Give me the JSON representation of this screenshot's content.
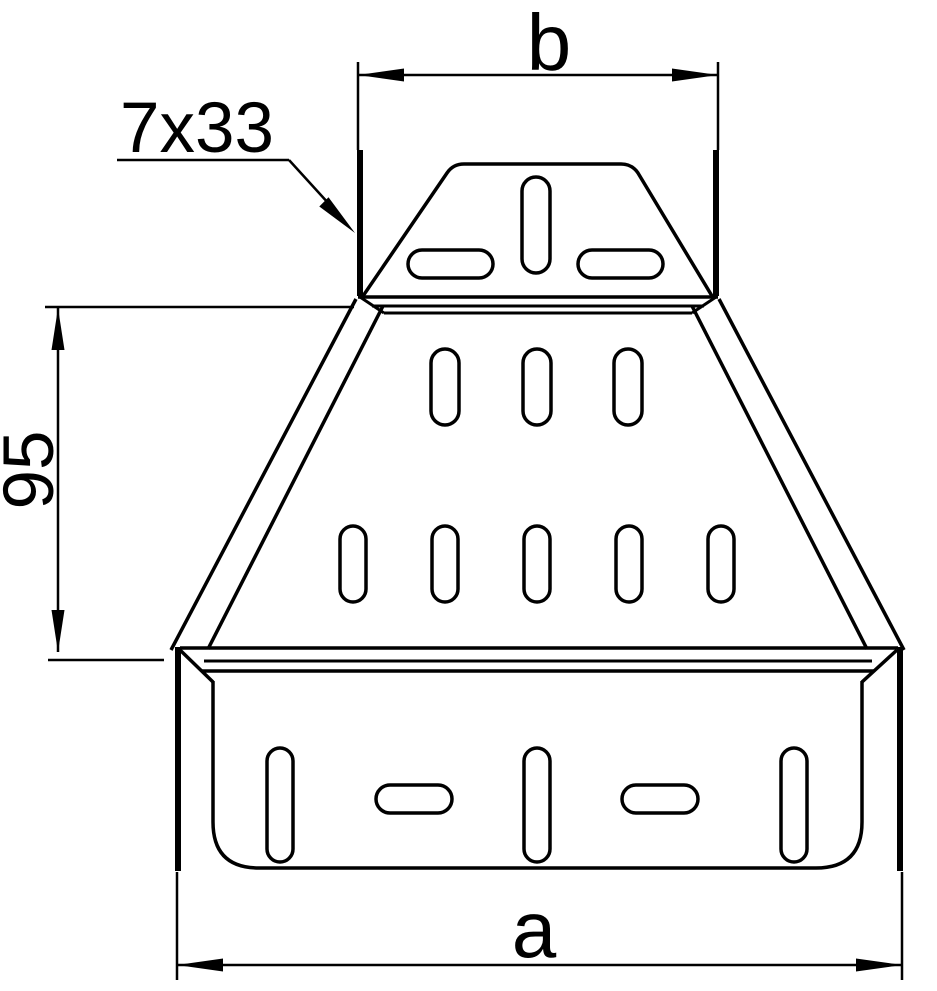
{
  "drawing": {
    "background_color": "#ffffff",
    "line_color": "#000000",
    "labels": {
      "top_width": "b",
      "slot_pattern": "7x33",
      "middle_height": "95",
      "bottom_width": "a"
    }
  }
}
